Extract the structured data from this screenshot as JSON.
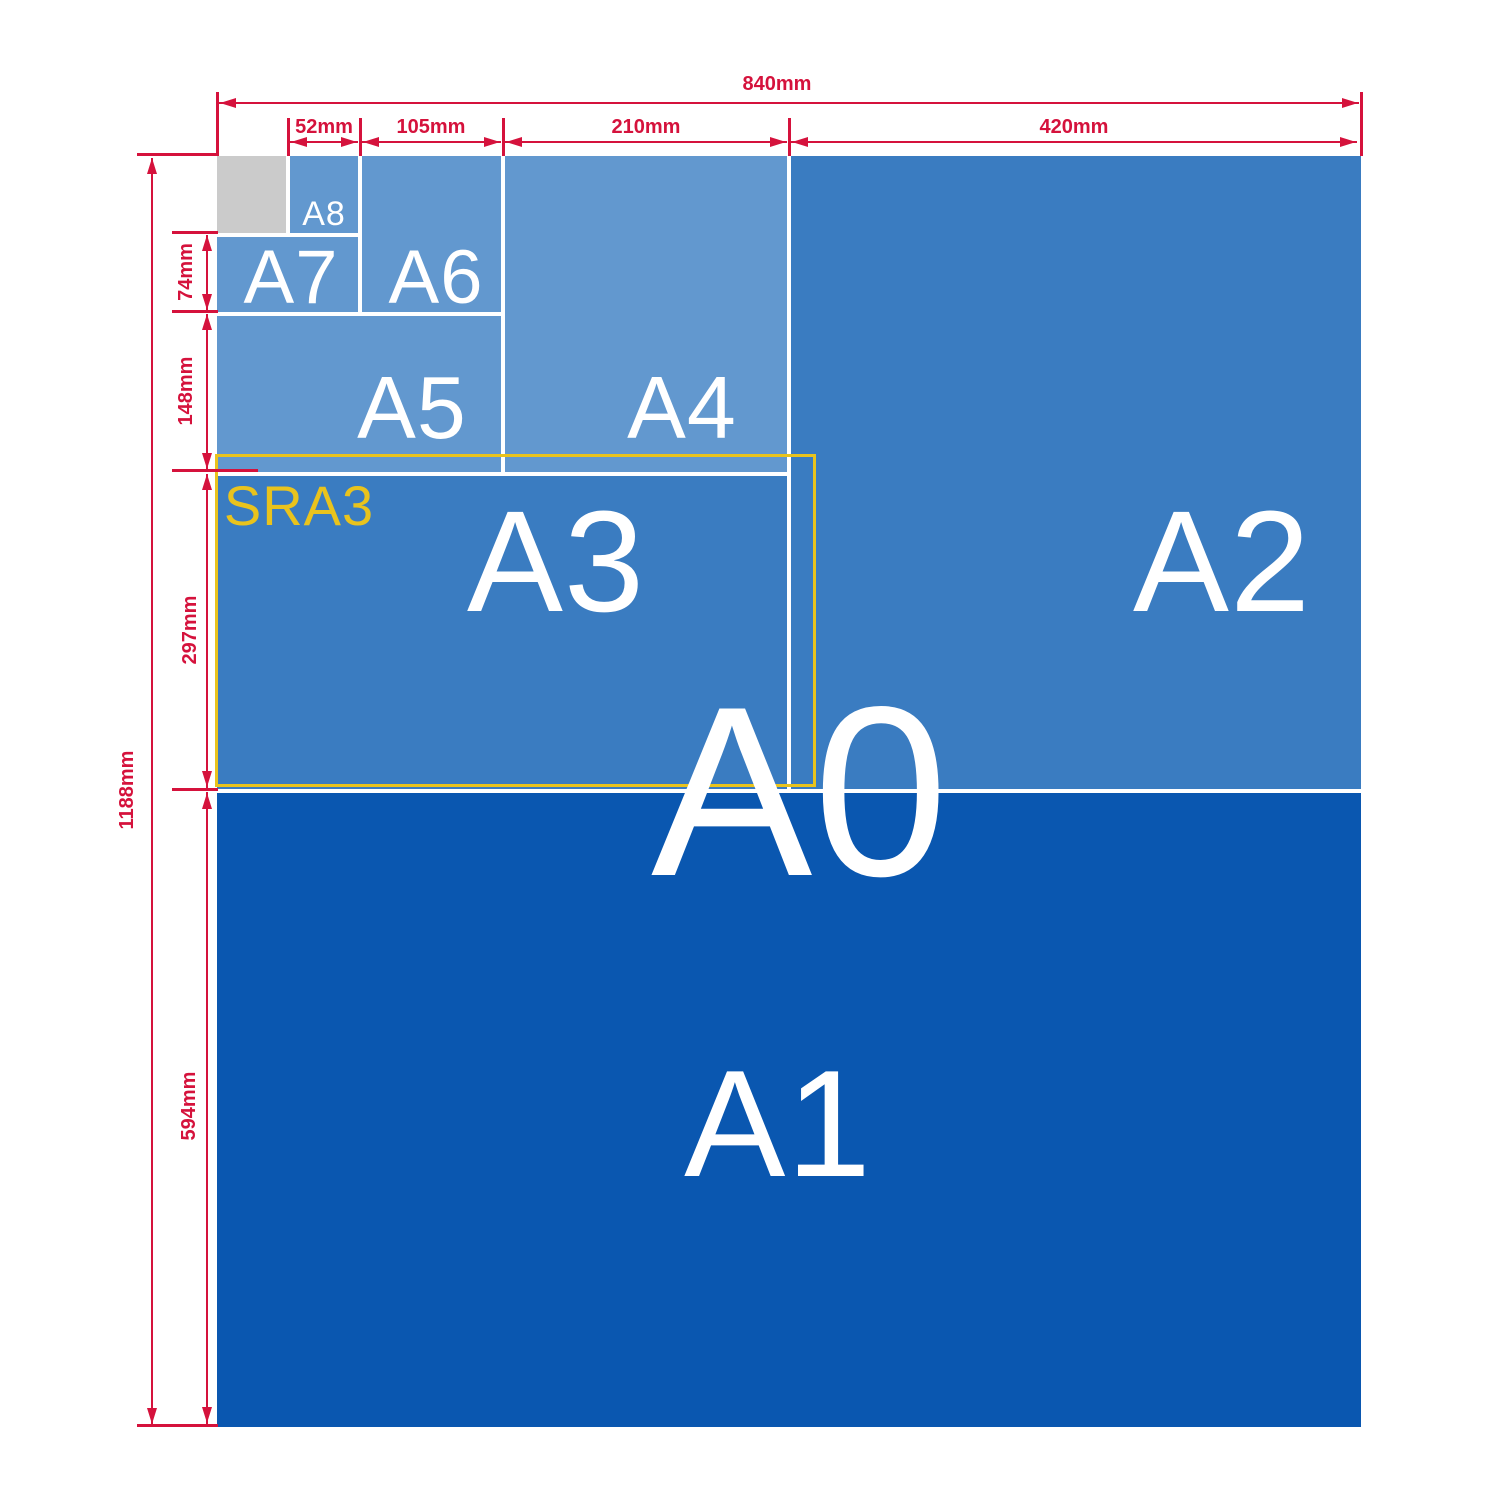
{
  "labels": {
    "a0": "A0",
    "a1": "A1",
    "a2": "A2",
    "a3": "A3",
    "a4": "A4",
    "a5": "A5",
    "a6": "A6",
    "a7": "A7",
    "a8": "A8",
    "sra3": "SRA3"
  },
  "dims": {
    "w840": "840mm",
    "w52": "52mm",
    "w105": "105mm",
    "w210": "210mm",
    "w420": "420mm",
    "h74": "74mm",
    "h148": "148mm",
    "h297": "297mm",
    "h594": "594mm",
    "h1188": "1188mm"
  },
  "colors": {
    "dimension_red": "#d5123c",
    "sra3_yellow": "#e9c31d",
    "cell_light_blue": "#6298cf",
    "cell_medium_blue": "#3a7cc1",
    "cell_dark_blue": "#0a57b0",
    "corner_gray": "#cbcbcb",
    "label_white": "#ffffff"
  }
}
